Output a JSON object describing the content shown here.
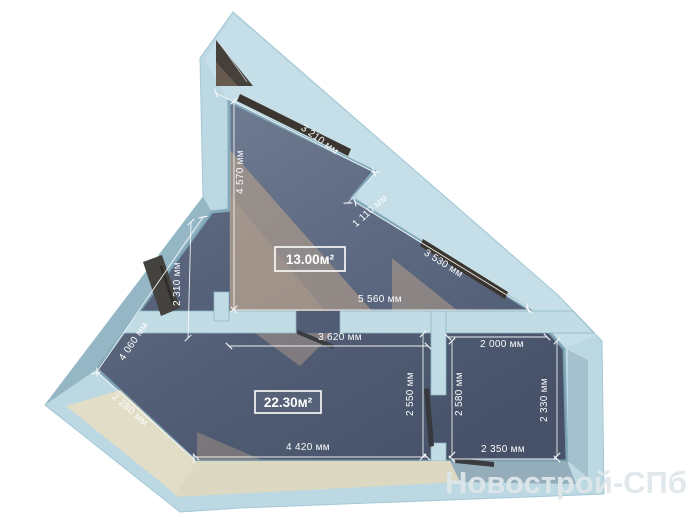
{
  "plan": {
    "type": "apartment-floor-plan",
    "watermark": {
      "text": "Новострой-СПб"
    },
    "rooms": [
      {
        "id": "room-triangular",
        "area_label": "13.00м²",
        "cx": 310,
        "cy": 259,
        "w": 70,
        "h": 24
      },
      {
        "id": "room-main",
        "area_label": "22.30м²",
        "cx": 288,
        "cy": 402,
        "w": 66,
        "h": 22
      }
    ],
    "dimensions": [
      {
        "id": "dim-3210",
        "label": "3 210 мм",
        "x1": 216,
        "y1": 93,
        "x2": 374,
        "y2": 172,
        "lx": 318,
        "ly": 142,
        "rot": 36
      },
      {
        "id": "dim-4570",
        "label": "4 570 мм",
        "x1": 234,
        "y1": 101,
        "x2": 234,
        "y2": 309,
        "lx": 243,
        "ly": 172,
        "rot": -90
      },
      {
        "id": "dim-1110",
        "label": "1 110 мм",
        "x1": 376,
        "y1": 172,
        "x2": 348,
        "y2": 203,
        "lx": 372,
        "ly": 213,
        "rot": -42
      },
      {
        "id": "dim-3530",
        "label": "3 530 мм",
        "x1": 355,
        "y1": 202,
        "x2": 528,
        "y2": 308,
        "lx": 442,
        "ly": 266,
        "rot": 32
      },
      {
        "id": "dim-5560",
        "label": "5 560 мм",
        "x1": 234,
        "y1": 310,
        "x2": 529,
        "y2": 310,
        "lx": 380,
        "ly": 302,
        "rot": 0
      },
      {
        "id": "dim-2310",
        "label": "2 310 мм",
        "x1": 191,
        "y1": 222,
        "x2": 188,
        "y2": 338,
        "lx": 180,
        "ly": 284,
        "rot": -90
      },
      {
        "id": "dim-4060",
        "label": "4 060 мм",
        "x1": 203,
        "y1": 217,
        "x2": 96,
        "y2": 373,
        "lx": 136,
        "ly": 343,
        "rot": -56
      },
      {
        "id": "dim-2280",
        "label": "2 280 мм",
        "x1": 97,
        "y1": 372,
        "x2": 194,
        "y2": 459,
        "lx": 128,
        "ly": 412,
        "rot": 41
      },
      {
        "id": "dim-3620",
        "label": "3 620 мм",
        "x1": 229,
        "y1": 346,
        "x2": 428,
        "y2": 346,
        "lx": 340,
        "ly": 340,
        "rot": 0
      },
      {
        "id": "dim-2550",
        "label": "2 550 мм",
        "x1": 423,
        "y1": 334,
        "x2": 423,
        "y2": 457,
        "lx": 413,
        "ly": 394,
        "rot": -90
      },
      {
        "id": "dim-4420",
        "label": "4 420 мм",
        "x1": 196,
        "y1": 457,
        "x2": 427,
        "y2": 457,
        "lx": 308,
        "ly": 450,
        "rot": 0
      },
      {
        "id": "dim-2000",
        "label": "2 000 мм",
        "x1": 448,
        "y1": 337,
        "x2": 547,
        "y2": 337,
        "lx": 502,
        "ly": 347,
        "rot": 0
      },
      {
        "id": "dim-2580",
        "label": "2 580 мм",
        "x1": 452,
        "y1": 341,
        "x2": 452,
        "y2": 455,
        "lx": 462,
        "ly": 394,
        "rot": -90
      },
      {
        "id": "dim-2330",
        "label": "2 330 мм",
        "x1": 557,
        "y1": 341,
        "x2": 557,
        "y2": 456,
        "lx": 547,
        "ly": 400,
        "rot": -90
      },
      {
        "id": "dim-2350",
        "label": "2 350 мм",
        "x1": 452,
        "y1": 459,
        "x2": 557,
        "y2": 459,
        "lx": 503,
        "ly": 452,
        "rot": 0
      }
    ],
    "units": "мм",
    "colors": {
      "background": "#ffffff",
      "wall": "#bcd8e2",
      "wall_light": "#c7dfe8",
      "wall_shadow": "#95b6c4",
      "floor_light": "#758195",
      "floor_dark": "#4e596f",
      "sunlight": "#c9ab8e",
      "cream_face": "#e0dcc6",
      "window_dark": "#3b352f",
      "dimension_text": "#fbfcfd",
      "watermark": "#dfe7ea"
    }
  }
}
